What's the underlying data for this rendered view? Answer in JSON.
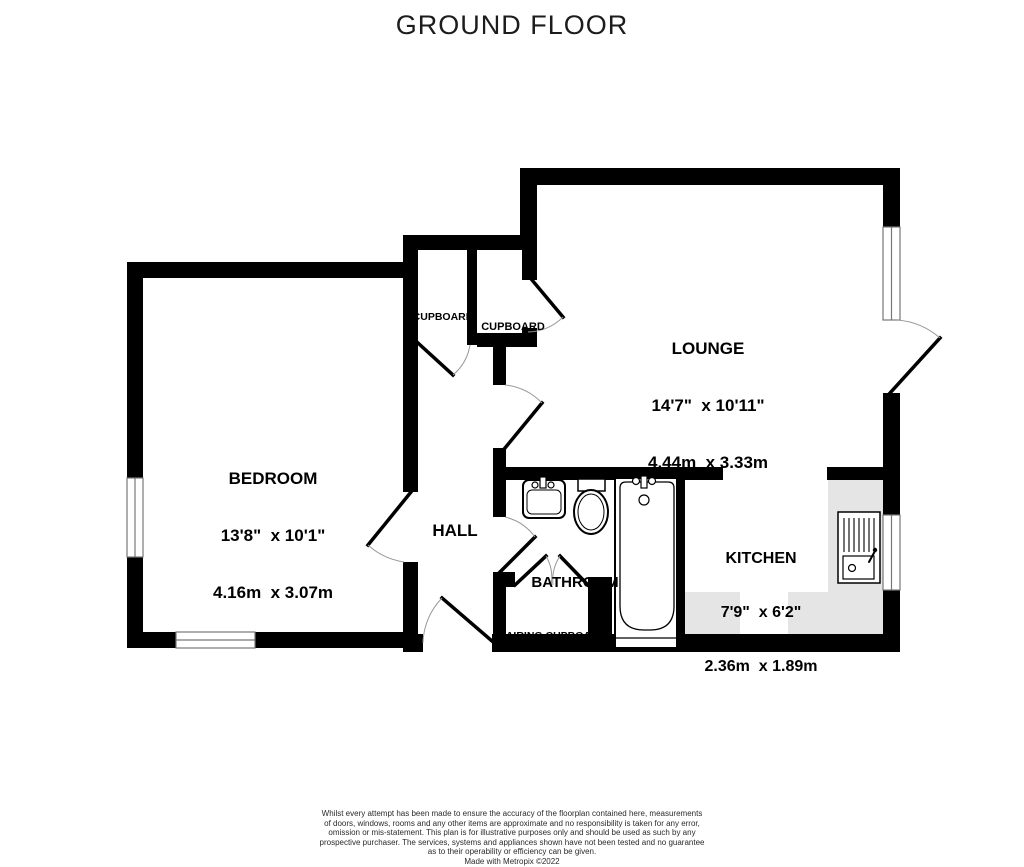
{
  "title": "GROUND FLOOR",
  "rooms": {
    "bedroom": {
      "name": "BEDROOM",
      "imperial": "13'8\"  x 10'1\"",
      "metric": "4.16m  x 3.07m"
    },
    "lounge": {
      "name": "LOUNGE",
      "imperial": "14'7\"  x 10'11\"",
      "metric": "4.44m  x 3.33m"
    },
    "kitchen": {
      "name": "KITCHEN",
      "imperial": "7'9\"  x 6'2\"",
      "metric": "2.36m  x 1.89m"
    },
    "hall": {
      "name": "HALL"
    },
    "bathroom": {
      "name": "BATHROOM"
    },
    "cupboard_left": {
      "name": "CUPBOARD"
    },
    "cupboard_right": {
      "name": "CUPBOARD"
    },
    "airing_cupboard": {
      "name": "AIRING CUPBOARD"
    }
  },
  "disclaimer": {
    "lines": [
      "Whilst every attempt has been made to ensure the accuracy of the floorplan contained here, measurements",
      "of doors, windows, rooms and any other items are approximate and no responsibility is taken for any error,",
      "omission or mis-statement. This plan is for illustrative purposes only and should be used as such by any",
      "prospective purchaser. The services, systems and appliances shown have not been tested and no guarantee",
      "as to their operability or efficiency can be given."
    ],
    "credit": "Made with Metropix ©2022"
  },
  "colors": {
    "wall": "#000000",
    "counter": "#e5e5e5",
    "background": "#ffffff",
    "text": "#000000"
  }
}
